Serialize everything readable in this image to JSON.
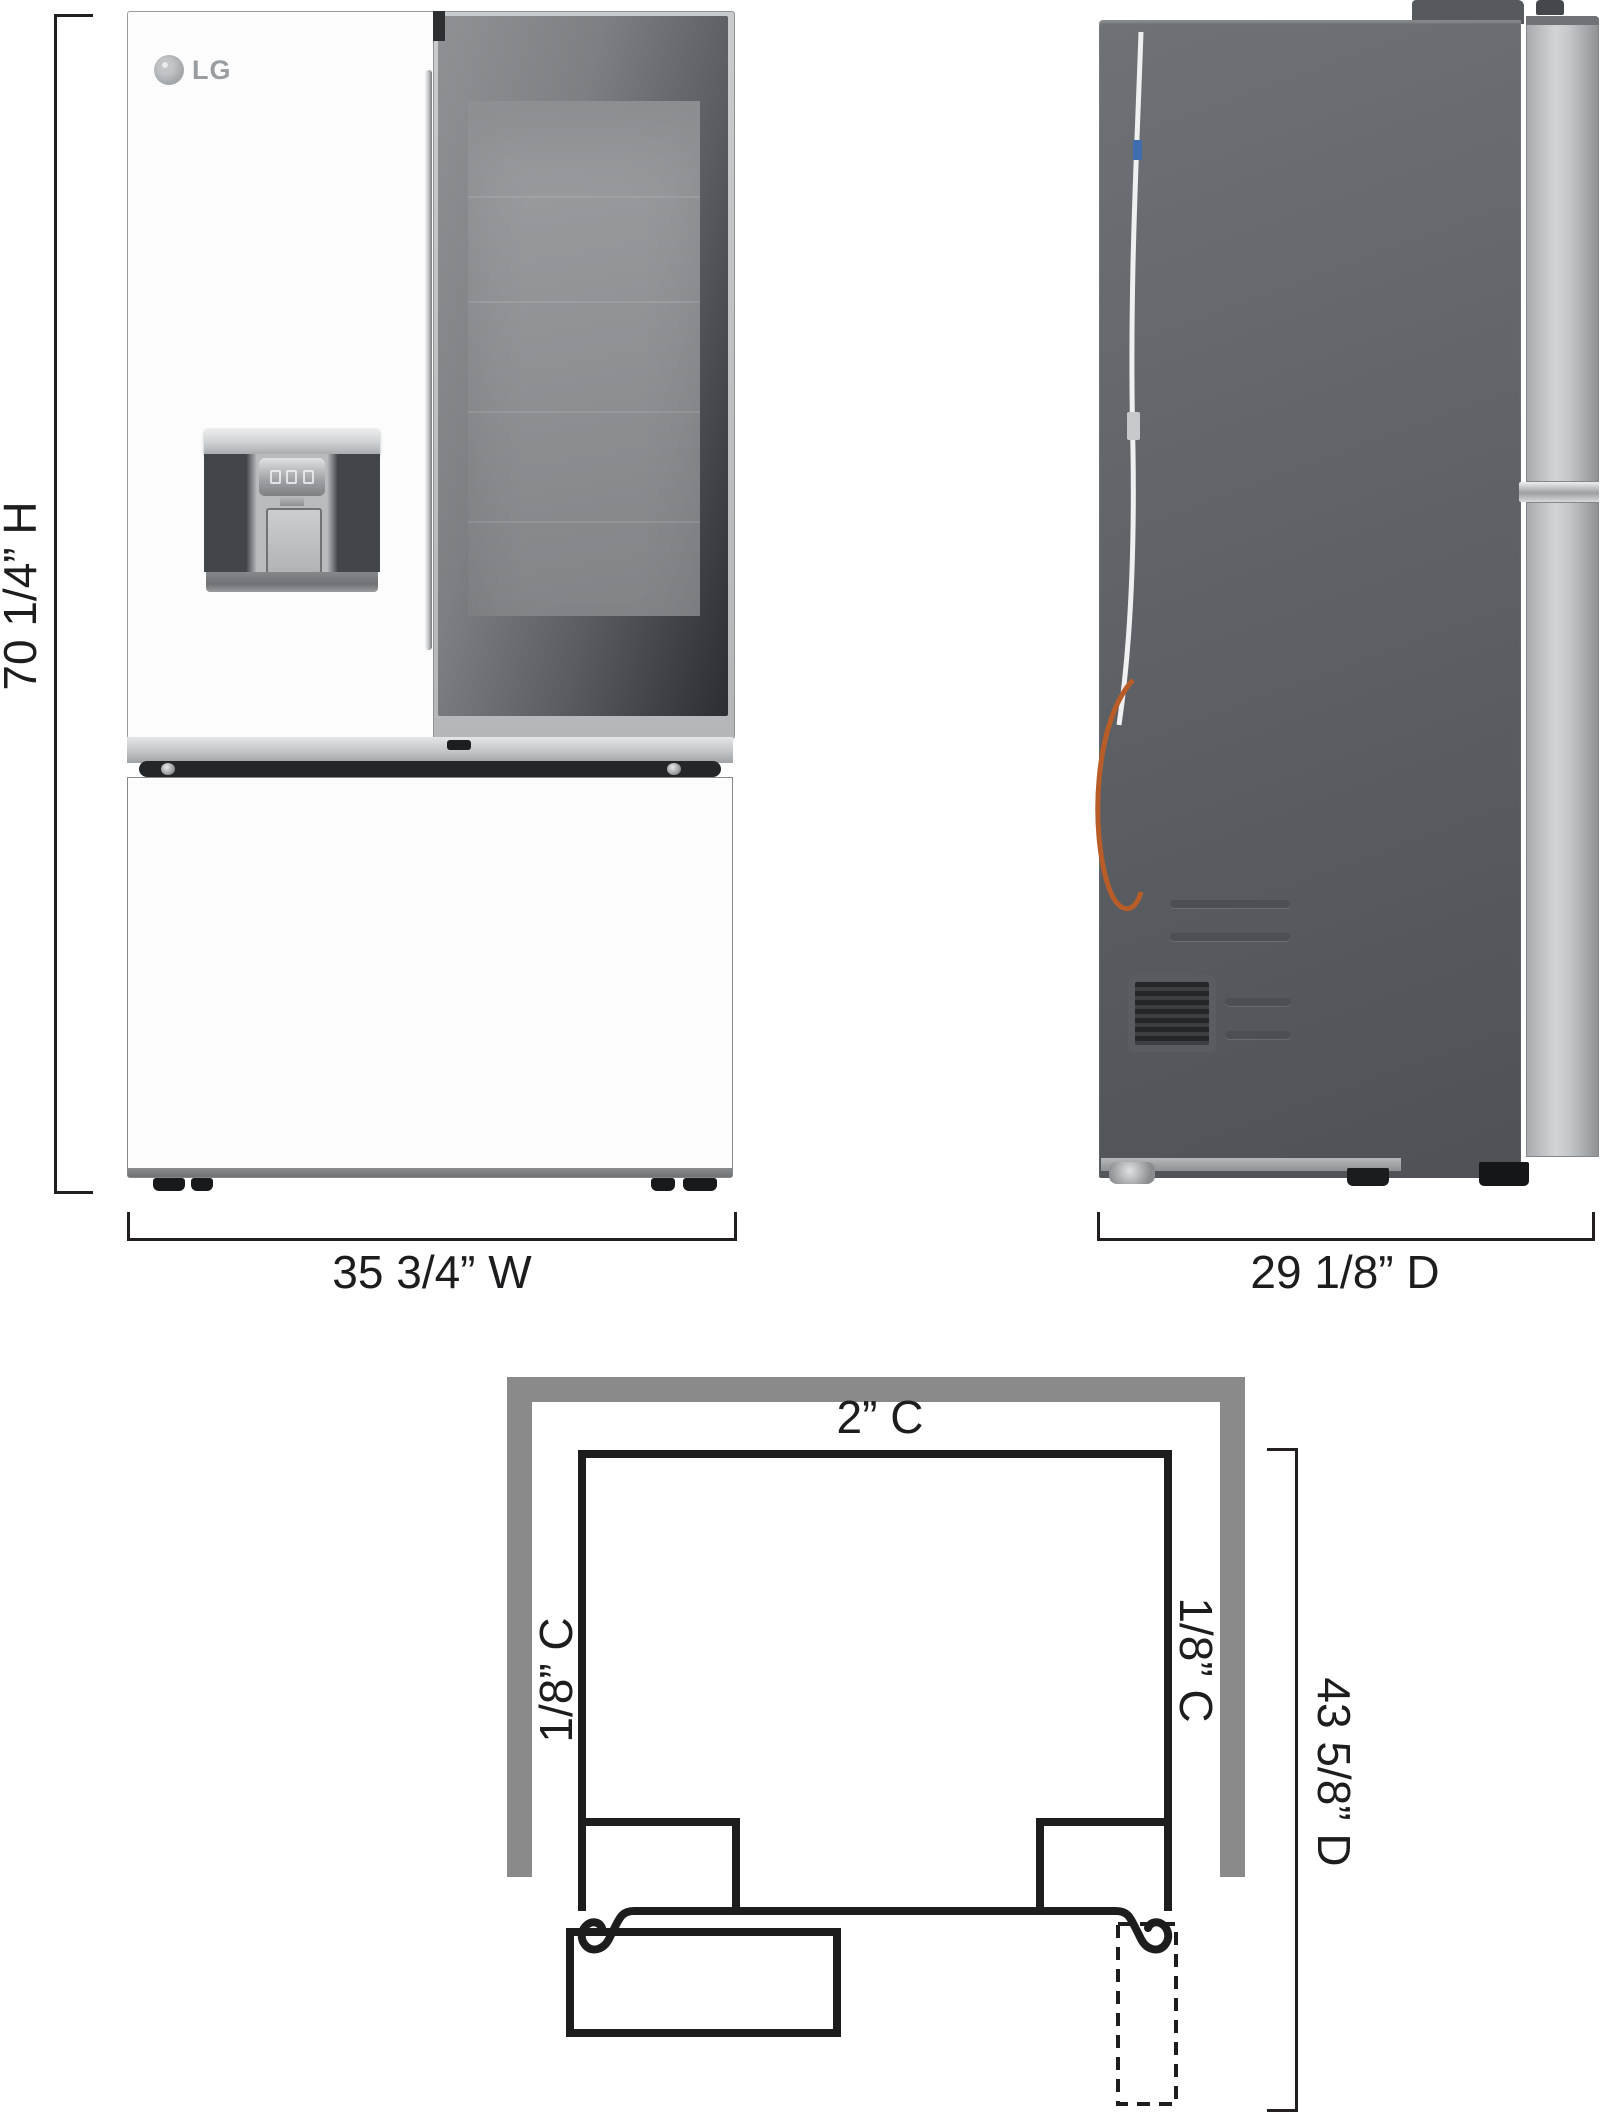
{
  "brand": "LG",
  "front_view": {
    "height_label": "70 1/4” H",
    "width_label": "35 3/4” W"
  },
  "side_view": {
    "depth_label": "29 1/8” D"
  },
  "installation_view": {
    "top_clearance": "2” C",
    "left_clearance": "1/8” C",
    "right_clearance": "1/8” C",
    "depth_with_door_open": "43 5/8” D"
  },
  "colors": {
    "dim-line": "#231f20",
    "label-text": "#1d1d1f",
    "diagram-line": "#1d1d1d",
    "alcove-gray": "#8a8a8a",
    "stainless-light": "#cdd0d2",
    "stainless-dark": "#a7aaad",
    "glass-dark": "#303438",
    "side-panel": "#5d6165"
  }
}
